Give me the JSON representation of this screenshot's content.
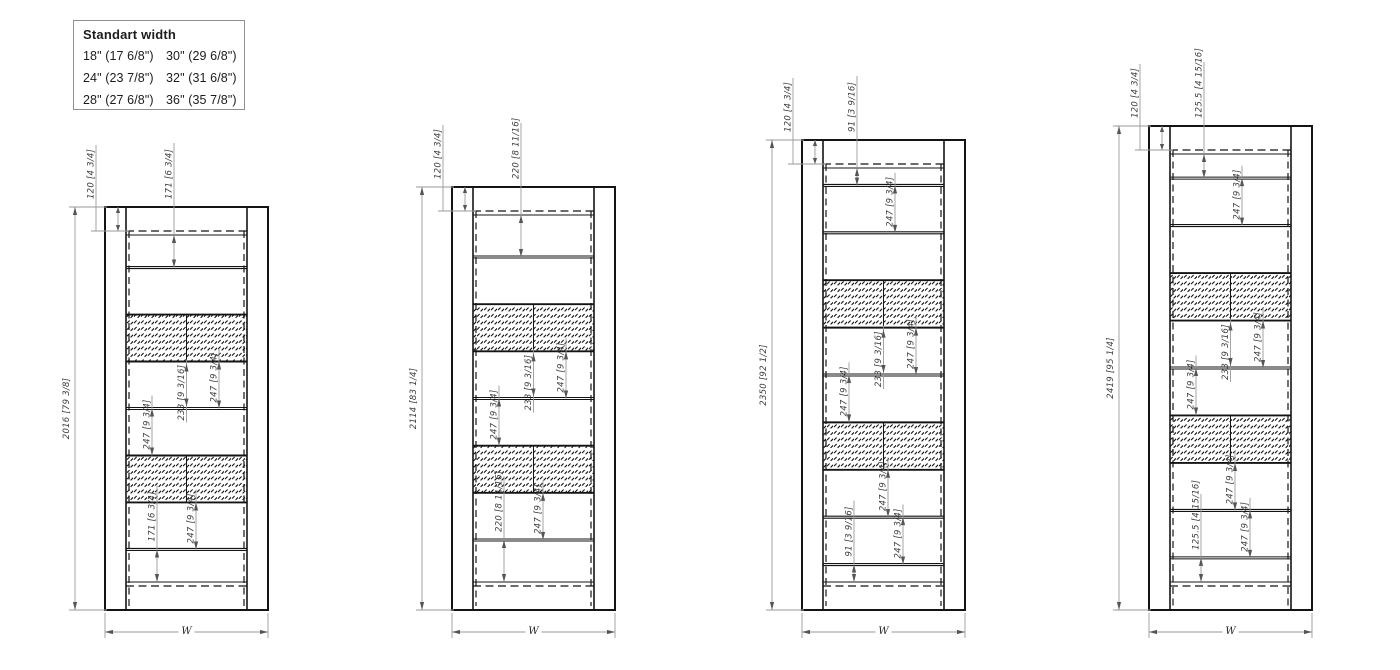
{
  "legend": {
    "title": "Standart width",
    "rows": [
      [
        "18\" (17 6/8\")",
        "30\" (29 6/8\")"
      ],
      [
        "24\" (23 7/8\")",
        "32\" (31 6/8\")"
      ],
      [
        "28\" (27 6/8\")",
        "36\" (35 7/8\")"
      ]
    ]
  },
  "drawing": {
    "bottom_y": 610,
    "panel_outer_width": 163,
    "stile_width": 21,
    "rail_height_px": 24,
    "panels": [
      {
        "name": "panel-2016",
        "x": 105,
        "top": 207,
        "total_label": "2016 [79 3/8]",
        "rail_label": "120 [4 3/4]",
        "width_label": "W",
        "sections_mm": [
          171,
          247,
          247,
          247,
          247,
          247,
          247,
          171
        ],
        "hatch_sections": [
          2,
          5
        ],
        "dims": [
          {
            "label": "171 [6 3/4]",
            "sec": 0,
            "ldx": 69,
            "mode": "above"
          },
          {
            "label": "247 [9 3/4]",
            "sec": 3,
            "ldx": 114,
            "mode": "in"
          },
          {
            "label": "233 [9 3/16]",
            "sec": 3,
            "ldx": 81.5,
            "mode": "below",
            "inset": 2
          },
          {
            "label": "247 [9 3/4]",
            "sec": 4,
            "ldx": 47,
            "mode": "in"
          },
          {
            "label": "247 [9 3/4]",
            "sec": 6,
            "ldx": 91,
            "mode": "in"
          },
          {
            "label": "171 [6 3/4]",
            "sec": 7,
            "ldx": 52,
            "mode": "span"
          }
        ]
      },
      {
        "name": "panel-2114",
        "x": 452,
        "top": 187,
        "total_label": "2114 [83 1/4]",
        "rail_label": "120 [4 3/4]",
        "width_label": "W",
        "sections_mm": [
          220,
          247,
          247,
          247,
          247,
          247,
          247,
          220
        ],
        "hatch_sections": [
          2,
          5
        ],
        "dims": [
          {
            "label": "220 [8 11/16]",
            "sec": 0,
            "ldx": 69,
            "mode": "above"
          },
          {
            "label": "247 [9 3/4]",
            "sec": 3,
            "ldx": 114,
            "mode": "in"
          },
          {
            "label": "233 [9 3/16]",
            "sec": 3,
            "ldx": 81.5,
            "mode": "below",
            "inset": 2
          },
          {
            "label": "247 [9 3/4]",
            "sec": 4,
            "ldx": 47,
            "mode": "in"
          },
          {
            "label": "247 [9 3/4]",
            "sec": 6,
            "ldx": 91,
            "mode": "in"
          },
          {
            "label": "220 [8 11/16]",
            "sec": 7,
            "ldx": 52,
            "mode": "span"
          }
        ]
      },
      {
        "name": "panel-2350",
        "x": 802,
        "top": 140,
        "total_label": "2350 [92 1/2]",
        "rail_label": "120 [4 3/4]",
        "width_label": "W",
        "sections_mm": [
          91,
          247,
          247,
          247,
          247,
          247,
          247,
          247,
          247,
          91
        ],
        "hatch_sections": [
          3,
          6
        ],
        "dims": [
          {
            "label": "91 [3 9/16]",
            "sec": 0,
            "ldx": 55,
            "mode": "above"
          },
          {
            "label": "247 [9 3/4]",
            "sec": 1,
            "ldx": 93,
            "mode": "in"
          },
          {
            "label": "247 [9 3/4]",
            "sec": 4,
            "ldx": 114,
            "mode": "in"
          },
          {
            "label": "233 [9 3/16]",
            "sec": 4,
            "ldx": 81.5,
            "mode": "below",
            "inset": 2
          },
          {
            "label": "247 [9 3/4]",
            "sec": 5,
            "ldx": 47,
            "mode": "in"
          },
          {
            "label": "247 [9 3/4]",
            "sec": 7,
            "ldx": 86,
            "mode": "in"
          },
          {
            "label": "247 [9 3/4]",
            "sec": 8,
            "ldx": 101,
            "mode": "in"
          },
          {
            "label": "91 [3 9/16]",
            "sec": 9,
            "ldx": 52,
            "mode": "span"
          }
        ]
      },
      {
        "name": "panel-2419",
        "x": 1149,
        "top": 126,
        "total_label": "2419 [95 1/4]",
        "rail_label": "120 [4 3/4]",
        "width_label": "W",
        "sections_mm": [
          125.5,
          247,
          247,
          247,
          247,
          247,
          247,
          247,
          247,
          125.5
        ],
        "hatch_sections": [
          3,
          6
        ],
        "dims": [
          {
            "label": "125.5 [4 15/16]",
            "sec": 0,
            "ldx": 55,
            "mode": "above"
          },
          {
            "label": "247 [9 3/4]",
            "sec": 1,
            "ldx": 93,
            "mode": "in"
          },
          {
            "label": "247 [9 3/4]",
            "sec": 4,
            "ldx": 114,
            "mode": "in"
          },
          {
            "label": "233 [9 3/16]",
            "sec": 4,
            "ldx": 81.5,
            "mode": "below",
            "inset": 2
          },
          {
            "label": "247 [9 3/4]",
            "sec": 5,
            "ldx": 47,
            "mode": "in"
          },
          {
            "label": "247 [9 3/4]",
            "sec": 7,
            "ldx": 86,
            "mode": "in"
          },
          {
            "label": "247 [9 3/4]",
            "sec": 8,
            "ldx": 101,
            "mode": "in"
          },
          {
            "label": "125.5 [4 15/16]",
            "sec": 9,
            "ldx": 52,
            "mode": "span"
          }
        ]
      }
    ]
  }
}
